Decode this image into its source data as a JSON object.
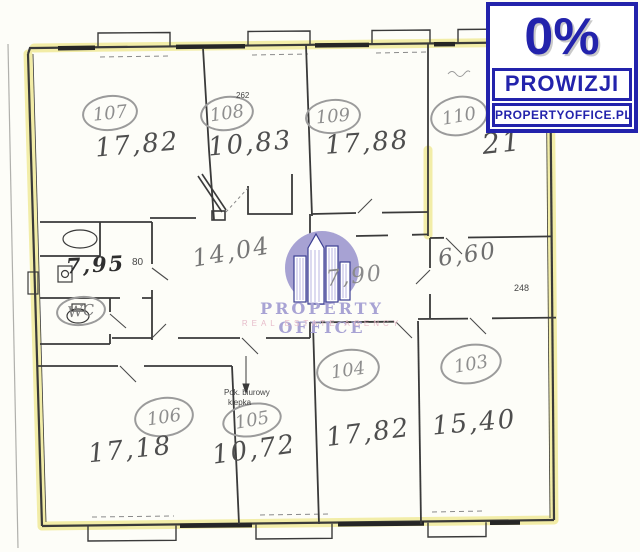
{
  "badge": {
    "percent": "0%",
    "commission": "PROWIZJI",
    "website": "PROPERTYOFFICE.PL"
  },
  "watermark": {
    "brand": "PROPERTY OFFICE",
    "tagline": "REAL ESTATE AGENCY"
  },
  "rooms": [
    {
      "number": "107",
      "area": "17,82"
    },
    {
      "number": "108",
      "area": "10,83",
      "dim_note": "262"
    },
    {
      "number": "109",
      "area": "17,88"
    },
    {
      "number": "110",
      "area": "21"
    },
    {
      "number": "106",
      "area": "17,18"
    },
    {
      "number": "105",
      "area": "10,72",
      "note_line1": "Pok. biurowy",
      "note_line2": "klepka"
    },
    {
      "number": "104",
      "area": "17,82"
    },
    {
      "number": "103",
      "area": "15,40"
    }
  ],
  "spaces": {
    "bathroom_area": "7,95",
    "bathroom_dim": "80",
    "wc_label": "WC",
    "corridor_area": "14,04",
    "hall_area": "7,90",
    "side_room_area": "6,60",
    "wall_dim": "248"
  },
  "colors": {
    "wall_highlight": "#f1eb9e",
    "badge_blue": "#2323ac",
    "logo_lavender": "#a7a2d3",
    "logo_pink": "#e7bcca"
  }
}
